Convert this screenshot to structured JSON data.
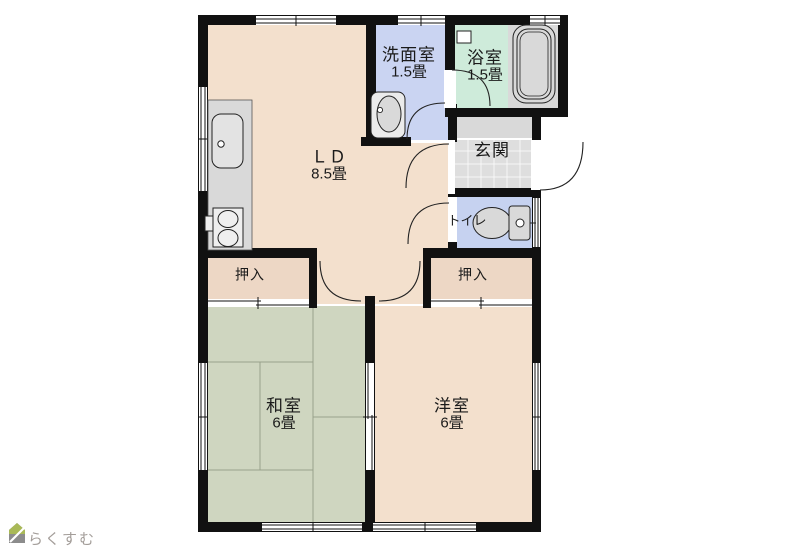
{
  "plan_title": "2DK apartment floor plan",
  "rooms": {
    "living_dining": {
      "name": "ＬＤ",
      "size": "8.5畳",
      "color": "#F3E0CD"
    },
    "washroom": {
      "name": "洗面室",
      "size": "1.5畳",
      "color": "#CAD4F2"
    },
    "bathroom": {
      "name": "浴室",
      "size": "1.5畳",
      "color": "#CEEBDA"
    },
    "entrance": {
      "name": "玄関",
      "color": "#DEDEDE"
    },
    "toilet": {
      "name": "トイレ",
      "color": "#C6D2F0"
    },
    "closet_left": {
      "name": "押入",
      "color": "#EDD7C5"
    },
    "closet_right": {
      "name": "押入",
      "color": "#EDD7C5"
    },
    "japanese_room": {
      "name": "和室",
      "size": "6畳",
      "color": "#CFD6C0"
    },
    "western_room": {
      "name": "洋室",
      "size": "6畳",
      "color": "#F3E0CD"
    }
  },
  "colors": {
    "wall": "#111111",
    "fixture_gray": "#D9D9D9",
    "hall_gray": "#D9D9D9",
    "tatami_line": "#98A18B",
    "background": "#FFFFFF",
    "watermark_text": "#A39D99",
    "watermark_roof": "#A9B957",
    "watermark_body": "#8C8C8C"
  },
  "icons": {
    "bathtub": "bathtub-icon (rounded rectangle tub)",
    "toilet": "toilet-icon (bowl + tank)",
    "washbasin": "washbasin-icon (oval basin)",
    "kitchen_sink": "kitchen-sink-icon (rounded rect + faucet dot)",
    "stove": "stove-icon (two burners)",
    "entrance_tile": "tile-grid",
    "house_logo": "house-icon"
  },
  "watermark": {
    "brand_text": "らくすむ"
  }
}
